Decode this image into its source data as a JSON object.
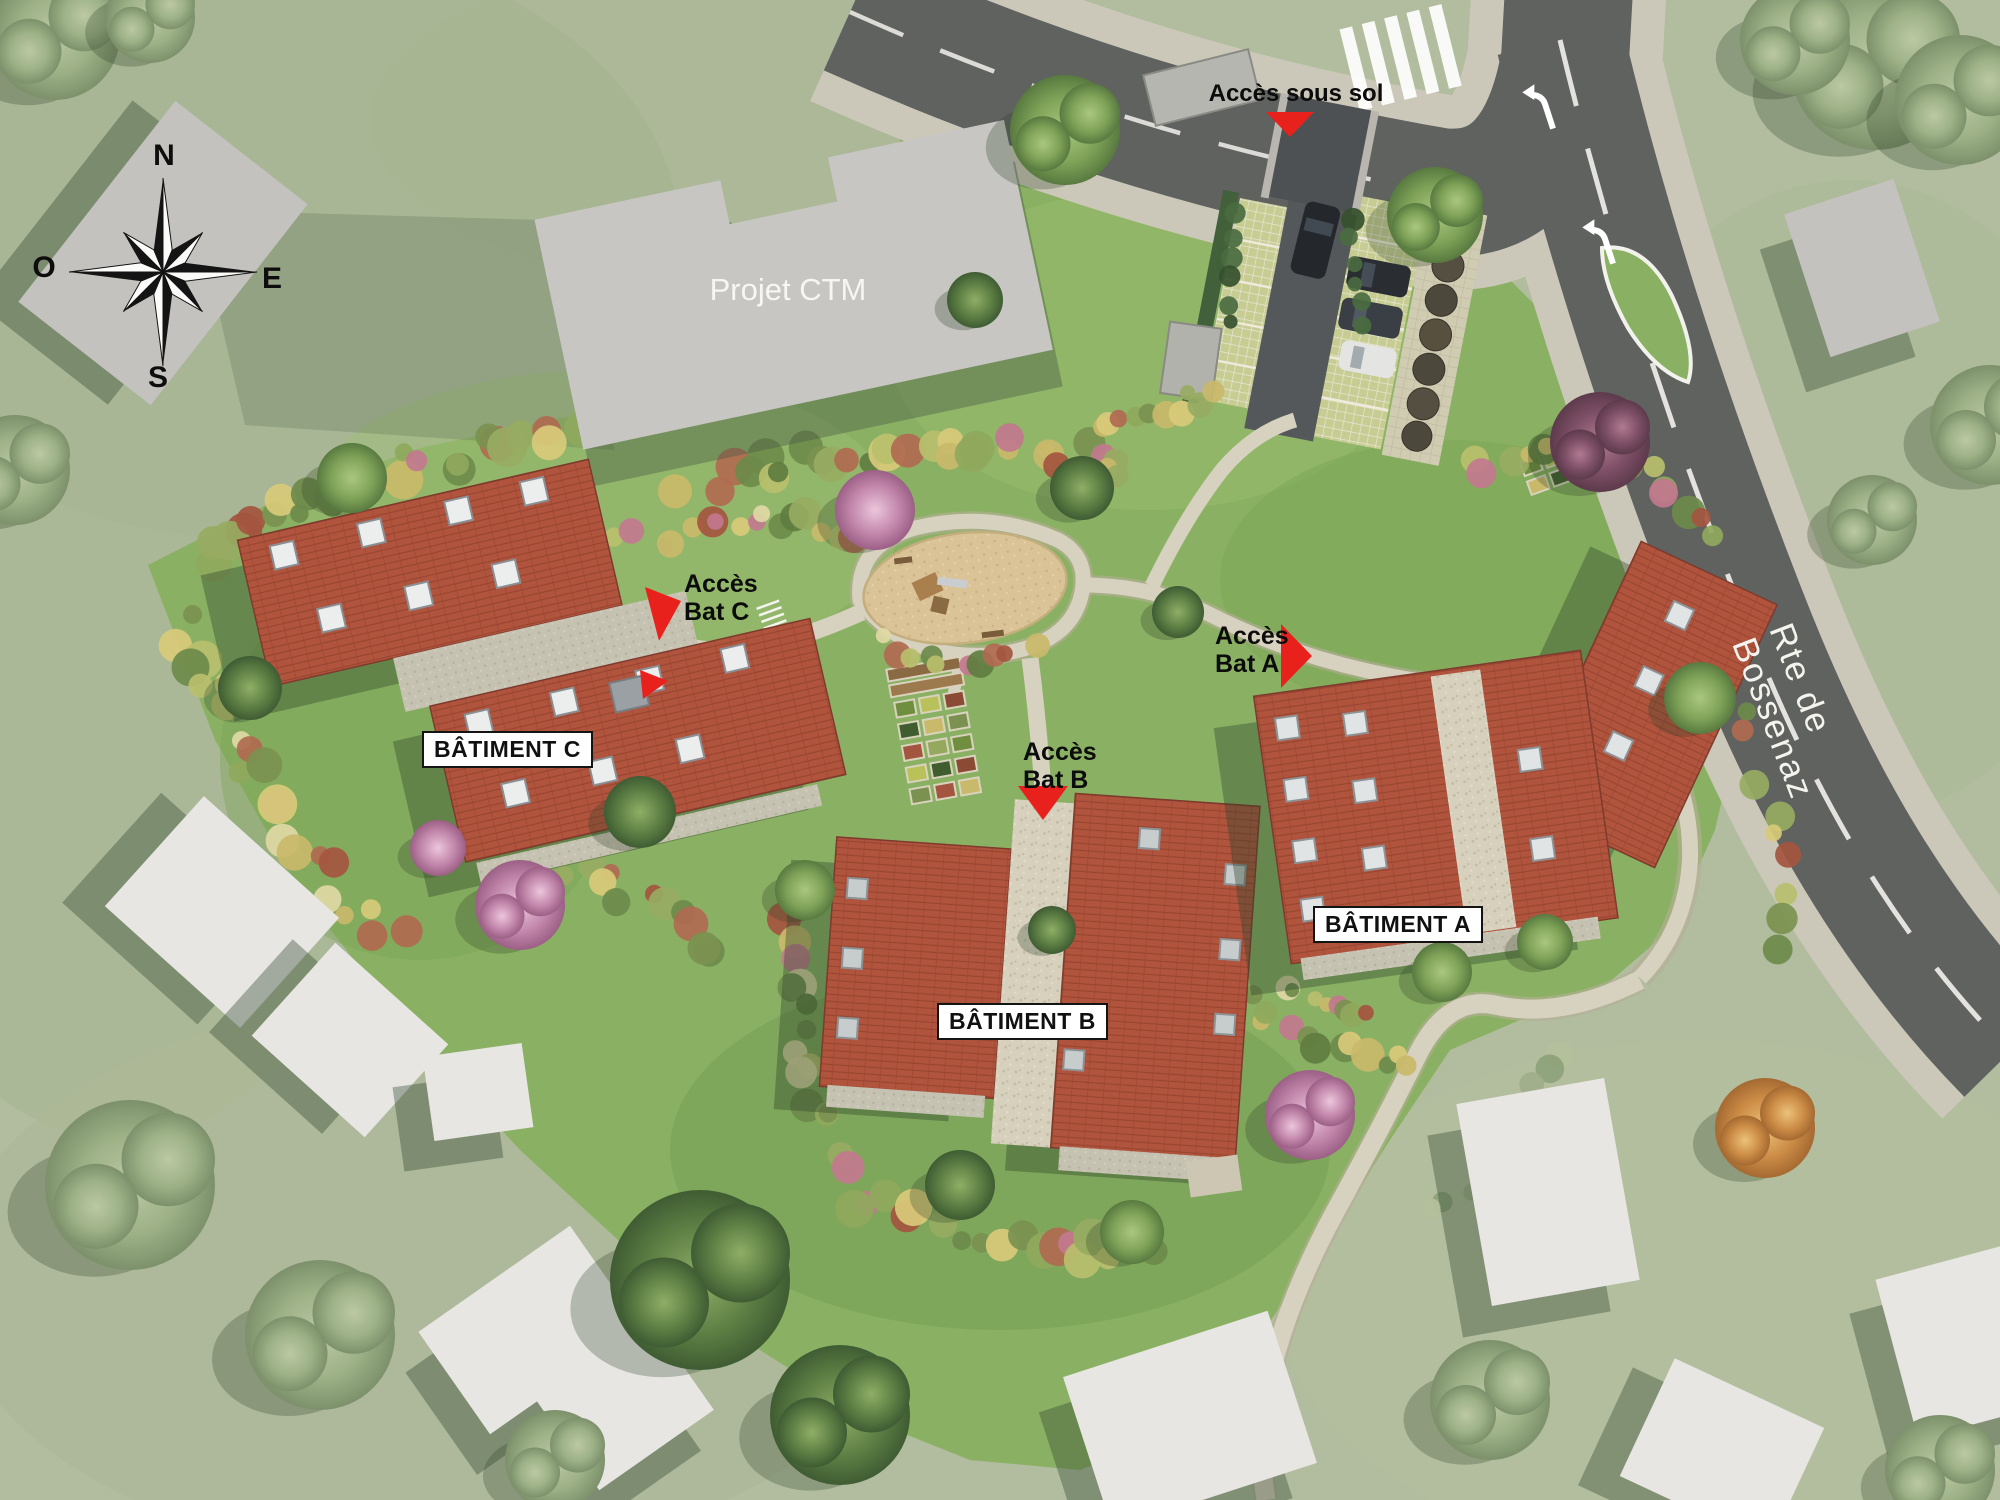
{
  "compass": {
    "n": "N",
    "e": "E",
    "s": "S",
    "o": "O"
  },
  "areas": {
    "project_ctm": "Projet CTM"
  },
  "access": {
    "basement": "Accès sous sol",
    "bat_a_line1": "Accès",
    "bat_a_line2": "Bat A",
    "bat_b_line1": "Accès",
    "bat_b_line2": "Bat B",
    "bat_c_line1": "Accès",
    "bat_c_line2": "Bat C"
  },
  "buildings": {
    "a": "BÂTIMENT A",
    "b": "BÂTIMENT B",
    "c": "BÂTIMENT C"
  },
  "roads": {
    "bossenaz": "Rte de Bossenaz"
  },
  "colors": {
    "context_grass": "#b1bd9e",
    "site_grass": "#8ab163",
    "roof_tile": "#b0543e",
    "road": "#5f625f",
    "sidewalk": "#ccc8b9",
    "path": "#d7d1bf",
    "access_arrow": "#e8211d",
    "label_bg": "#ffffff",
    "label_text": "#111111",
    "context_building": "#c3c2be",
    "neighbor_house": "#e7e6e2"
  }
}
